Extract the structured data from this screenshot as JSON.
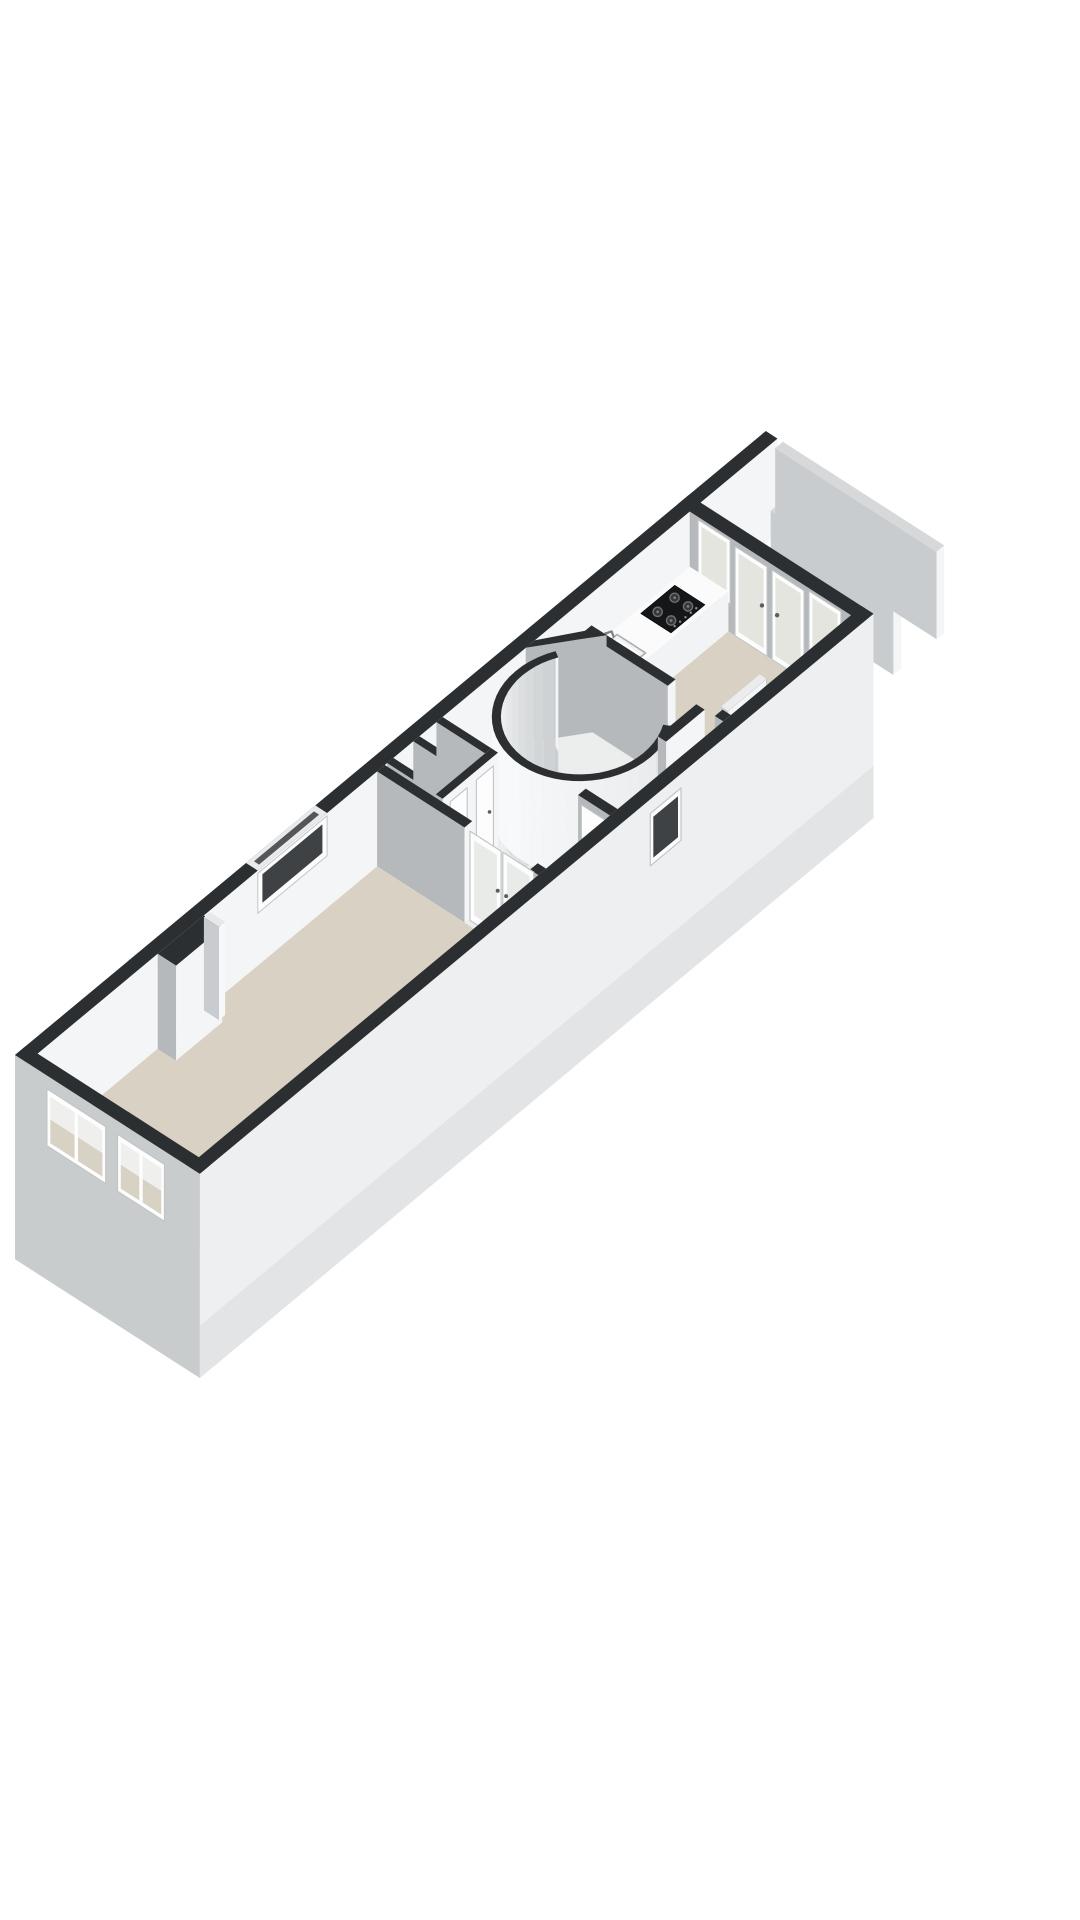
{
  "figure": {
    "kind": "3d-floorplan-render",
    "description": "Axonometric 3D floor plan of a long narrow apartment floor: living room at the front with chimney breast, central hallway with storage closets, spiral staircase in a curved enclosure, rear kitchen with counter, sink and gas cooktop, fully glazed rear wall with two doors and two windows opening to a balcony with parapet screens.",
    "background": "#ffffff"
  },
  "palette": {
    "wall_top_dark": "#2c2f31",
    "wall_top_light": "#d6d8d9",
    "face_bright": "#f4f5f6",
    "face_gray": "#b6b9bb",
    "face_gray_light": "#c9ccce",
    "facade_exterior": "#c9cccd",
    "se_exterior": "#edeff0",
    "se_exterior_low": "#e2e4e5",
    "floor_beige": "#d9d2c4",
    "floor_light": "#eceeee",
    "floor_lower": "#e0e2e3",
    "glass_light": "#e4e5df",
    "glass_dark": "#3e4244",
    "glass_beige": "#d8d2c5",
    "glass_sky": "#eff0ee",
    "frame_white": "#fdfdfd",
    "frame_stroke": "#c2c5c7",
    "counter_top": "#fbfbfc",
    "step_top": "#f2f3f4",
    "step_side": "#d8dadc",
    "cooktop_black": "#141618",
    "burner_ring": "#6b7073",
    "burner_fill": "#34383b",
    "metal_gray": "#7d8184",
    "railing_white": "#f6f7f8",
    "pole_gray": "#cfd2d4"
  },
  "floorplan": {
    "projection": {
      "A": [
        0.77,
        -0.64
      ],
      "B": [
        0.84,
        0.54
      ],
      "H": 95,
      "O": [
        15,
        1150
      ]
    },
    "building": {
      "length": 875,
      "width": 220,
      "wall_thickness": 14,
      "exterior_drop": -1.15
    },
    "floors": [
      {
        "name": "living-room-floor",
        "rect": [
          14,
          14,
          455,
          206
        ],
        "color": "floor_beige"
      },
      {
        "name": "hall-floor",
        "rect": [
          455,
          14,
          695,
          206
        ],
        "color": "floor_light"
      },
      {
        "name": "kitchen-floor",
        "rect": [
          705,
          14,
          861,
          206
        ],
        "color": "floor_beige"
      }
    ],
    "nw_wall": {
      "length": 975,
      "slit_window": {
        "u": [
          300,
          390
        ],
        "z": [
          0.55,
          0.97
        ]
      }
    },
    "facade": {
      "windows": [
        {
          "v": [
            38,
            108
          ]
        },
        {
          "v": [
            122,
            178
          ]
        }
      ],
      "z": [
        0.26,
        0.86
      ]
    },
    "se_wall": {
      "small_window": {
        "u": [
          585,
          625
        ],
        "z": [
          0.3,
          0.85
        ]
      }
    },
    "back_wall": {
      "u": [
        861,
        875
      ],
      "panels": [
        {
          "kind": "window",
          "v": [
            24,
            62
          ],
          "z": [
            0.3,
            0.97
          ]
        },
        {
          "kind": "door",
          "v": [
            68,
            106
          ],
          "z": [
            0,
            0.94
          ]
        },
        {
          "kind": "door",
          "v": [
            112,
            150
          ],
          "z": [
            0,
            0.94
          ]
        },
        {
          "kind": "window",
          "v": [
            156,
            194
          ],
          "z": [
            0.3,
            0.97
          ]
        }
      ]
    },
    "balcony": {
      "divider_screen": [
        916,
        60,
        926,
        206,
        0.9
      ],
      "end_parapet": [
        972,
        14,
        982,
        206,
        0.92
      ]
    },
    "partitions": {
      "living_wall_a": [
        455,
        14,
        465,
        118
      ],
      "living_wall_b": [
        455,
        196,
        465,
        206
      ],
      "kitchen_wall_a": [
        695,
        40,
        705,
        140
      ],
      "kitchen_wall_b": [
        695,
        196,
        705,
        206
      ],
      "corridor_wall": [
        645,
        174,
        695,
        184
      ],
      "door_stub": [
        548,
        168,
        558,
        206
      ],
      "diagonal": [
        [
          648,
          14
        ],
        [
          660,
          14
        ],
        [
          705,
          46
        ],
        [
          705,
          58
        ]
      ]
    },
    "closets": {
      "front_wall": [
        468,
        72,
        540,
        80
      ],
      "cross_walls": [
        [
          468,
          14,
          476,
          72
        ],
        [
          502,
          14,
          510,
          72
        ],
        [
          532,
          14,
          540,
          72
        ]
      ],
      "doors": [
        [
          478,
          500
        ],
        [
          512,
          534
        ]
      ]
    },
    "chimney": {
      "block": [
        170,
        14,
        230,
        36
      ],
      "pilaster": [
        230,
        14,
        238,
        32
      ]
    },
    "stair": {
      "center": [
        622,
        106
      ],
      "r_outer": 80,
      "r_inner": 72,
      "arc_deg": [
        60,
        300
      ],
      "steps": {
        "count": 6,
        "start_deg": 200,
        "sweep_deg": 33,
        "drop": 0.14,
        "radius": 70
      },
      "railing": {
        "u": [
          568,
          650
        ],
        "v": 170,
        "z": [
          -0.95,
          -0.42
        ]
      }
    },
    "counter": {
      "rect": [
        715,
        14,
        861,
        60
      ],
      "height": 0.42,
      "sink": {
        "rect": [
          722,
          20,
          760,
          54
        ]
      },
      "cooktop": {
        "rect": [
          792,
          19,
          836,
          55
        ]
      }
    },
    "kitchen_door_leaf": [
      712,
      188,
      762,
      196,
      0.94
    ],
    "doors": {
      "living_glazed_double": {
        "plane_u": 460,
        "leaves": [
          [
            120,
            157
          ],
          [
            159,
            196
          ]
        ],
        "z_top": 0.94
      },
      "stub_door": {
        "plane_u": 548,
        "v": [
          172,
          202
        ],
        "z_top": 0.92
      }
    }
  }
}
